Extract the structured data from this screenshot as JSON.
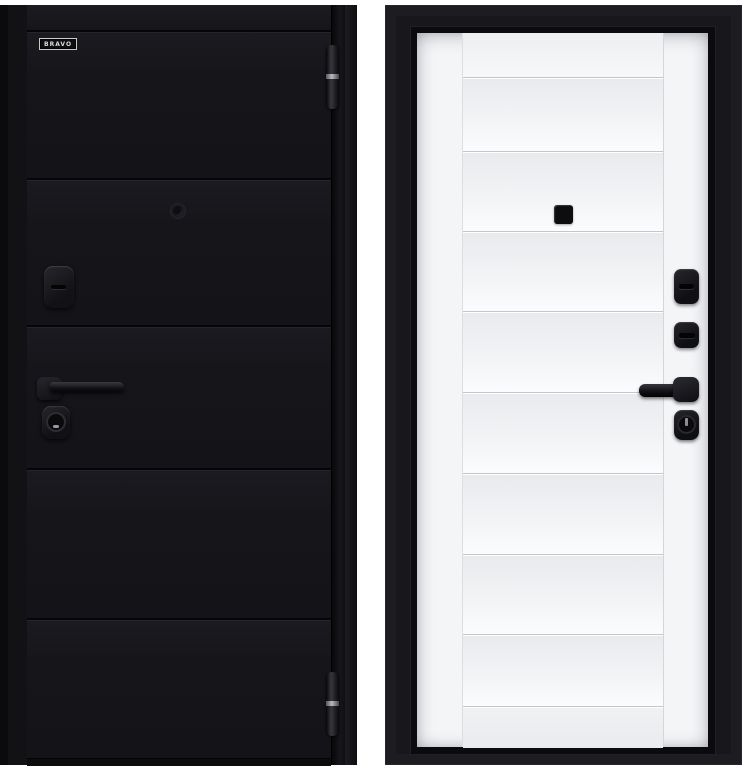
{
  "product": {
    "brand_logo": "BRAVO",
    "left_view": "black door leaf, front side",
    "right_view": "white door leaf in black frame, reverse side"
  },
  "colors": {
    "page_background": "#ffffff",
    "black_door_finish": "#17171b",
    "black_frame": "#18181c",
    "white_door_finish": "#f4f5f7",
    "hardware_black": "#111115"
  },
  "icons": {
    "left_door": [
      "brand-badge",
      "top-hinge",
      "peephole",
      "night-latch",
      "lever-handle",
      "key-cylinder",
      "bottom-hinge"
    ],
    "right_door": [
      "peephole",
      "deadbolt-thumbturn",
      "night-latch",
      "lever-handle",
      "key-cylinder"
    ]
  }
}
